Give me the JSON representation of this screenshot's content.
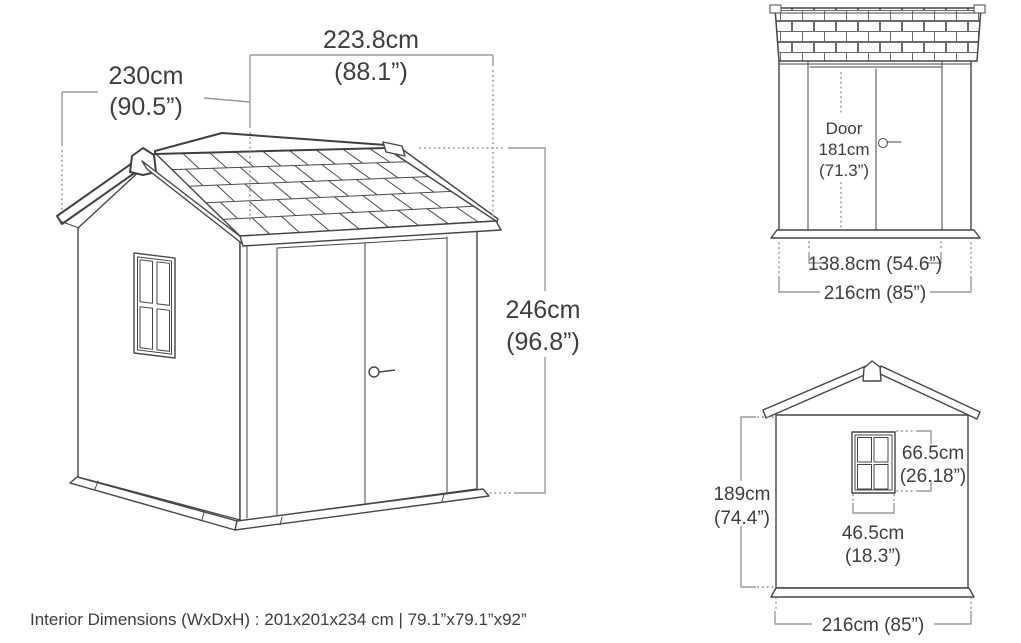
{
  "colors": {
    "drawing_line": "#454545",
    "dimension_line": "#9a9a9a",
    "text": "#3d3d3d",
    "background": "#ffffff"
  },
  "main_view": {
    "width": {
      "cm": "223.8cm",
      "in": "(88.1”)"
    },
    "depth": {
      "cm": "230cm",
      "in": "(90.5”)"
    },
    "height": {
      "cm": "246cm",
      "in": "(96.8”)"
    }
  },
  "front_view": {
    "door": {
      "line1": "Door",
      "line2": "181cm",
      "line3": "(71.3”)"
    },
    "door_width": "138.8cm (54.6”)",
    "overall_width": "216cm (85”)"
  },
  "rear_view": {
    "wall_height": {
      "cm": "189cm",
      "in": "(74.4”)"
    },
    "window_height": {
      "cm": "66.5cm",
      "in": "(26.18”)"
    },
    "window_width": {
      "cm": "46.5cm",
      "in": "(18.3”)"
    },
    "overall_width": "216cm (85”)"
  },
  "footer": {
    "interior_dimensions": "Interior Dimensions (WxDxH) : 201x201x234 cm | 79.1”x79.1”x92”"
  }
}
